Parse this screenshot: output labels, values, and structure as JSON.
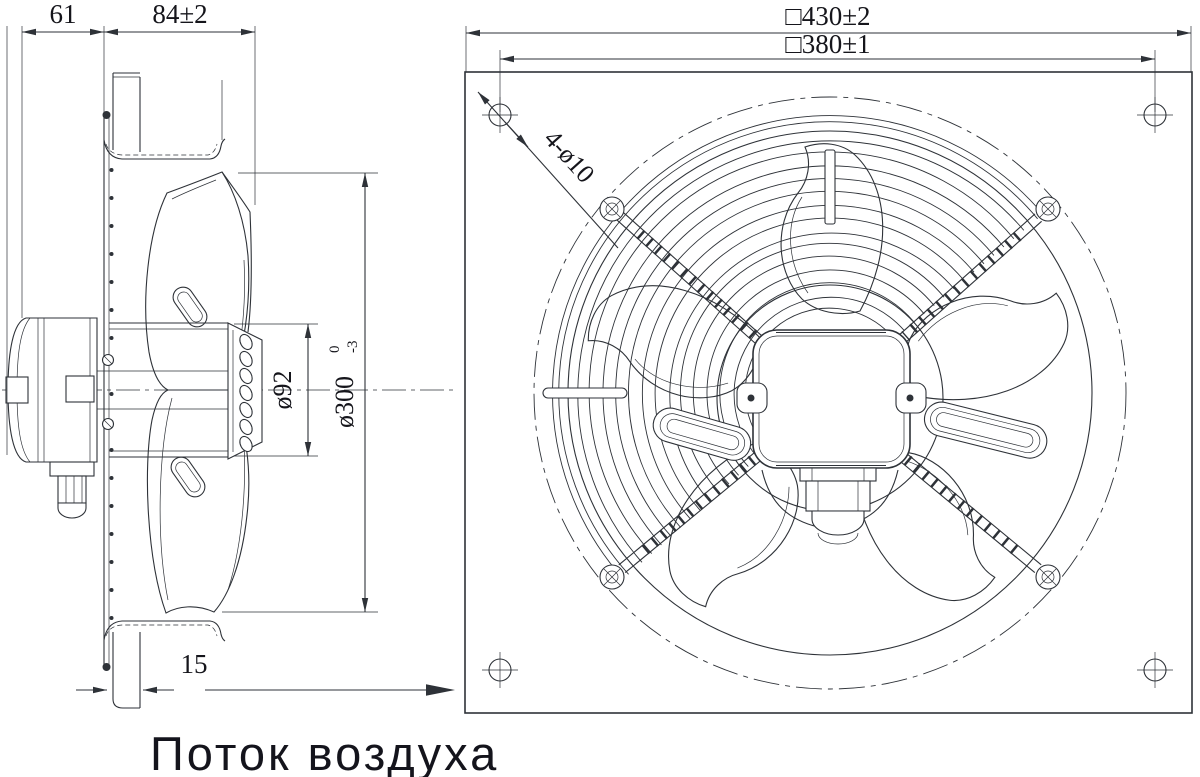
{
  "drawing": {
    "side_view": {
      "dim_motor_depth": "61",
      "dim_plate_to_inlet": "84±2",
      "dim_hub_diameter": "ø92",
      "dim_impeller_diameter": "ø300",
      "dim_impeller_tol_upper": "0",
      "dim_impeller_tol_lower": "-3",
      "dim_flange_depth": "15"
    },
    "front_view": {
      "dim_plate_size": "□430±2",
      "dim_hole_spacing": "□380±1",
      "label_mounting_holes": "4-ø10"
    },
    "caption_airflow": "Поток воздуха",
    "colors": {
      "line": "#2e3238",
      "text": "#15151b",
      "background": "#ffffff"
    }
  }
}
